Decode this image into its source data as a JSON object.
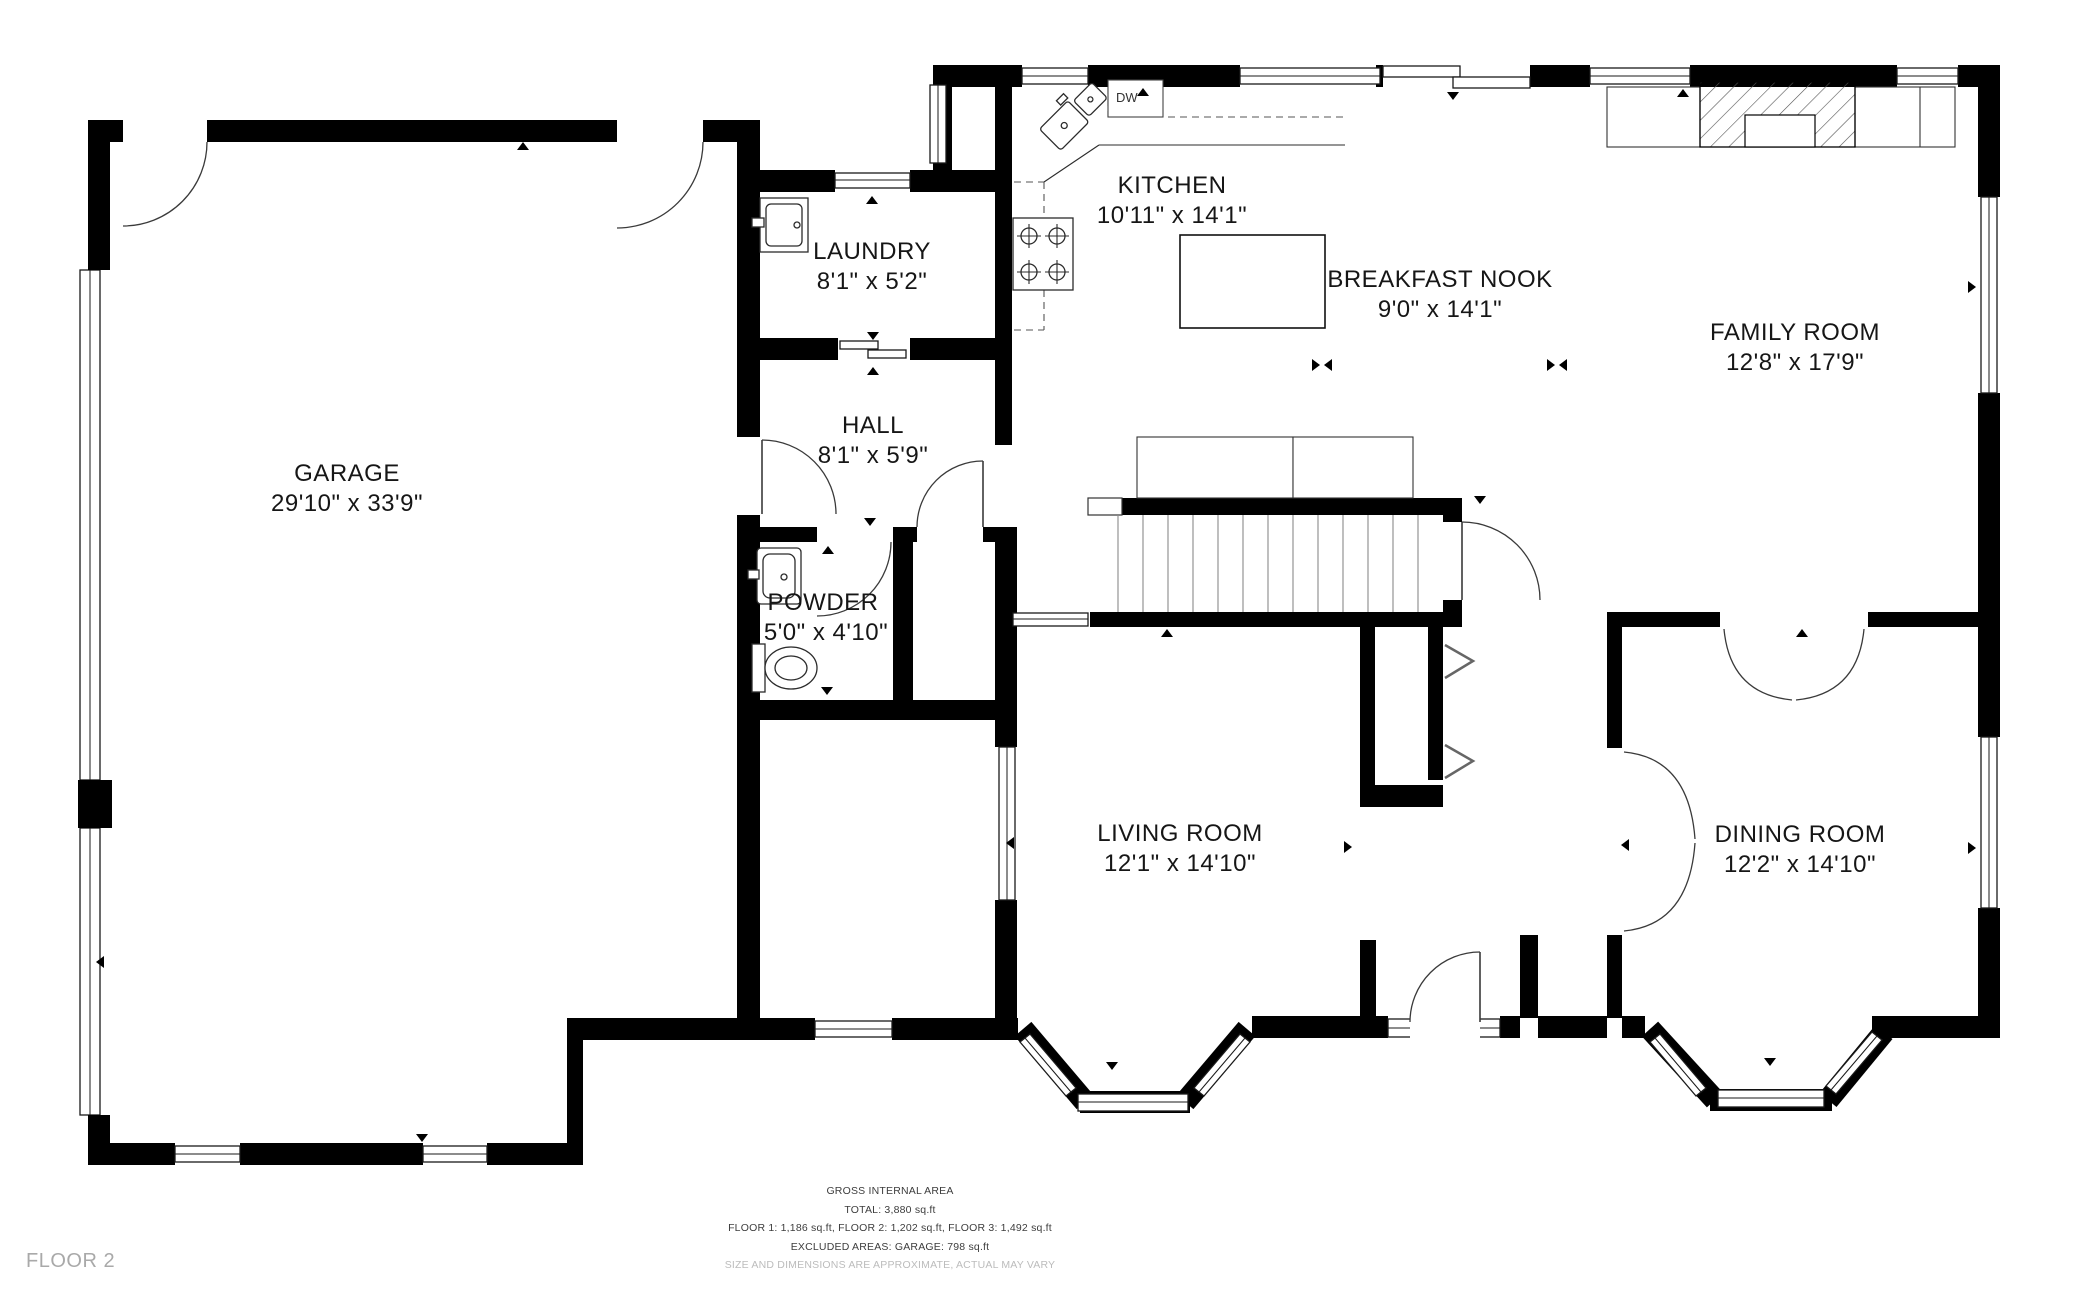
{
  "rooms": [
    {
      "id": "garage",
      "name": "GARAGE",
      "dims": "29'10\" x 33'9\""
    },
    {
      "id": "laundry",
      "name": "LAUNDRY",
      "dims": "8'1\" x 5'2\""
    },
    {
      "id": "kitchen",
      "name": "KITCHEN",
      "dims": "10'11\" x 14'1\""
    },
    {
      "id": "breakfast_nook",
      "name": "BREAKFAST NOOK",
      "dims": "9'0\" x 14'1\""
    },
    {
      "id": "family_room",
      "name": "FAMILY ROOM",
      "dims": "12'8\" x 17'9\""
    },
    {
      "id": "hall",
      "name": "HALL",
      "dims": "8'1\" x 5'9\""
    },
    {
      "id": "powder",
      "name": "POWDER",
      "dims": "5'0\" x 4'10\""
    },
    {
      "id": "living_room",
      "name": "LIVING ROOM",
      "dims": "12'1\" x 14'10\""
    },
    {
      "id": "dining_room",
      "name": "DINING ROOM",
      "dims": "12'2\" x 14'10\""
    }
  ],
  "appliances": {
    "dishwasher_label": "DW"
  },
  "footer": {
    "line1": "GROSS INTERNAL AREA",
    "line2": "TOTAL: 3,880 sq.ft",
    "line3": "FLOOR 1: 1,186 sq.ft, FLOOR 2: 1,202 sq.ft, FLOOR 3: 1,492 sq.ft",
    "line4": "EXCLUDED AREAS: GARAGE: 798 sq.ft",
    "disclaimer": "SIZE AND DIMENSIONS ARE APPROXIMATE, ACTUAL MAY VARY"
  },
  "floor_label": "FLOOR 2",
  "colors": {
    "wall": "#000000",
    "background": "#ffffff",
    "label_text": "#161616",
    "footer_text": "#3d3d3d",
    "muted_text": "#bcbcbc",
    "floor_label": "#a9a9a9"
  }
}
